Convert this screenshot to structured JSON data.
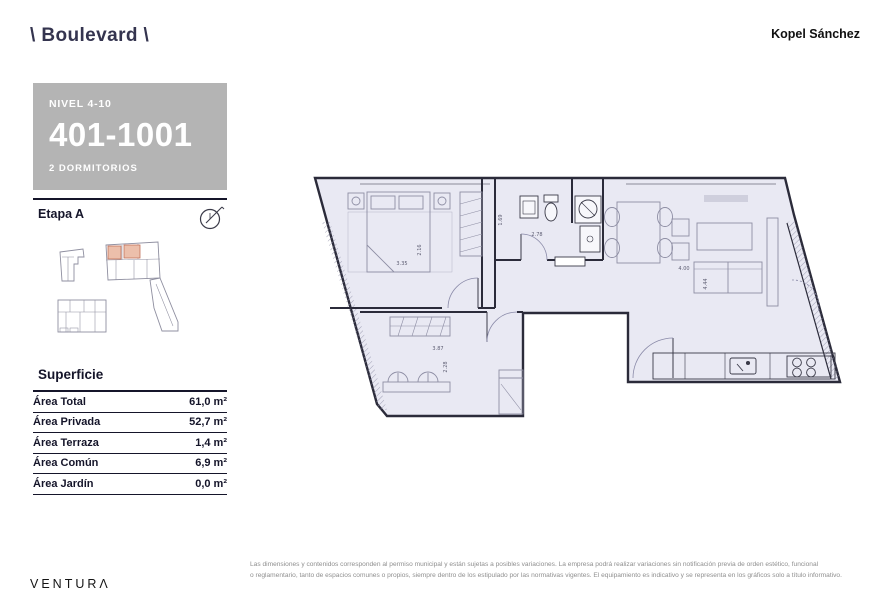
{
  "header": {
    "logo": "\\ Boulevard \\",
    "brand": "Kopel Sánchez"
  },
  "unit_card": {
    "level": "NIVEL 4-10",
    "number": "401-1001",
    "type": "2 DORMITORIOS",
    "bg_color": "#b4b4b4",
    "text_color": "#ffffff"
  },
  "stage": {
    "label": "Etapa A"
  },
  "keyplan": {
    "highlight_color": "#ecbfab"
  },
  "surface": {
    "title": "Superficie",
    "rows": [
      {
        "label": "Área Total",
        "value": "61,0 m²"
      },
      {
        "label": "Área Privada",
        "value": "52,7 m²"
      },
      {
        "label": "Área Terraza",
        "value": "1,4 m²"
      },
      {
        "label": "Área Común",
        "value": "6,9 m²"
      },
      {
        "label": "Área Jardín",
        "value": "0,0 m²"
      }
    ]
  },
  "plan": {
    "floor_color": "#e9e9f3",
    "wall_color": "#2b2b3a",
    "dims": {
      "bed1_w": "3.35",
      "bed1_d": "2.16",
      "bath_d": "1.69",
      "bath_w": "2.78",
      "living_w": "4.00",
      "living_d": "4.44",
      "bed2_w": "3.87",
      "bed2_d": "2.28"
    }
  },
  "footer": {
    "disclaimer_line1": "Las dimensiones y contenidos corresponden al permiso municipal y están sujetas a posibles variaciones. La empresa podrá realizar variaciones sin notificación previa de orden estético, funcional",
    "disclaimer_line2": "o reglamentario, tanto de espacios comunes o propios, siempre dentro de los estipulado por las normativas vigentes. El equipamiento es indicativo y se representa en los gráficos solo a título informativo.",
    "brand": "VENTURΛ"
  }
}
